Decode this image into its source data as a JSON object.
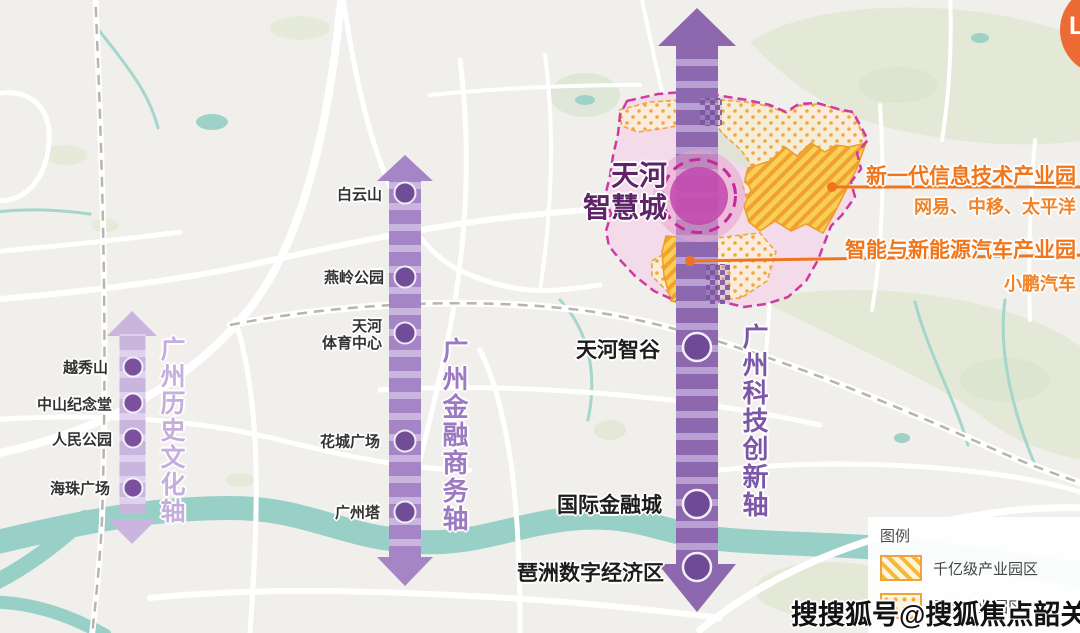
{
  "title": "广州三大城市轴线规划示意图",
  "axes": {
    "history": {
      "title": "广州历史文化轴",
      "color": "#c5aede",
      "landmarks": [
        {
          "name": "越秀山"
        },
        {
          "name": "中山纪念堂"
        },
        {
          "name": "人民公园"
        },
        {
          "name": "海珠广场"
        }
      ]
    },
    "finance": {
      "title": "广州金融商务轴",
      "color": "#9b7ac1",
      "landmarks": [
        {
          "name": "白云山"
        },
        {
          "name": "燕岭公园"
        },
        {
          "name": "天河体育中心",
          "line1": "天河",
          "line2": "体育中心"
        },
        {
          "name": "花城广场"
        },
        {
          "name": "广州塔"
        }
      ]
    },
    "tech": {
      "title": "广州科技创新轴",
      "color": "#7d57a7",
      "landmarks": [
        {
          "name": "天河智谷"
        },
        {
          "name": "国际金融城"
        },
        {
          "name": "琶洲数字经济区"
        }
      ]
    }
  },
  "smart_city": {
    "line1": "天河",
    "line2": "智慧城"
  },
  "industrial_parks": [
    {
      "title": "新一代信息技术产业园",
      "companies": "网易、中移、太平洋"
    },
    {
      "title": "智能与新能源汽车产业园",
      "companies": "小鹏汽车"
    }
  ],
  "legend": {
    "title": "图例",
    "items": [
      {
        "label": "千亿级产业园区",
        "pattern": "hatch"
      },
      {
        "label": "重点产业园区",
        "pattern": "dots"
      }
    ]
  },
  "watermark": "搜搜狐号@搜狐焦点韶关站",
  "corner_badge": {
    "letter": "L",
    "color": "#ec6a33"
  },
  "colors": {
    "accent_orange": "#f0761c",
    "magenta_border": "#c4289b",
    "circle_fill": "#c247ad",
    "axis_history": "#c9b5dd",
    "axis_finance": "#a585c5",
    "axis_tech": "#8d68ae",
    "water": "#98cfc6",
    "green": "#e3e9d6",
    "park_yellow": "#f9cf57"
  }
}
